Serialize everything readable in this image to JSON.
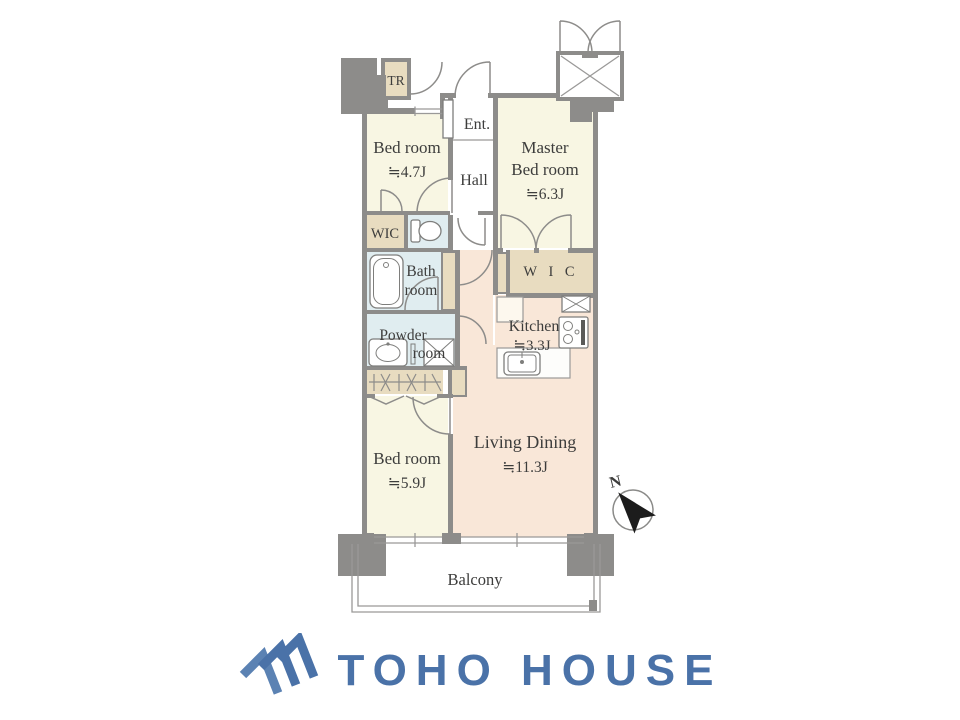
{
  "floorplan": {
    "rooms": {
      "trunk_room": {
        "label": "TR"
      },
      "entrance": {
        "label": "Ent."
      },
      "hall": {
        "label": "Hall"
      },
      "bedroom_47": {
        "label": "Bed room",
        "size": "≒4.7J"
      },
      "master_bedroom": {
        "line1": "Master",
        "line2": "Bed room",
        "size": "≒6.3J"
      },
      "wic_small": {
        "label": "WIC"
      },
      "bathroom": {
        "line1": "Bath",
        "line2": "room"
      },
      "powder_room": {
        "line1": "Powder",
        "line2": "room"
      },
      "wic_master": {
        "label": "W I C"
      },
      "kitchen": {
        "label": "Kitchen",
        "size": "≒3.3J"
      },
      "living_dining": {
        "label": "Living Dining",
        "size": "≒11.3J"
      },
      "bedroom_59": {
        "label": "Bed room",
        "size": "≒5.9J"
      },
      "balcony": {
        "label": "Balcony"
      }
    },
    "compass": {
      "north_label": "N"
    },
    "colors": {
      "wall": "#8d8c8a",
      "room_cream": "#f8f6e3",
      "room_peach": "#f9e7d8",
      "room_blue": "#e0edf0",
      "closet_beige": "#e8dcc0",
      "label_text": "#3d3d3c"
    },
    "icons": {
      "compass": "north-arrow-icon",
      "bathtub": "bathtub-icon",
      "toilet": "toilet-icon",
      "vanity_sink": "sink-icon",
      "washer": "washing-machine-icon",
      "stove": "stove-icon",
      "kitchen_sink": "kitchen-sink-icon",
      "elevator": "elevator-icon",
      "hanger_closet": "hanger-rail-icon"
    }
  },
  "branding": {
    "logo_text": "TOHO HOUSE",
    "logo_color": "#4a72a8",
    "logo_icon": "triple-chevron-house-icon"
  }
}
